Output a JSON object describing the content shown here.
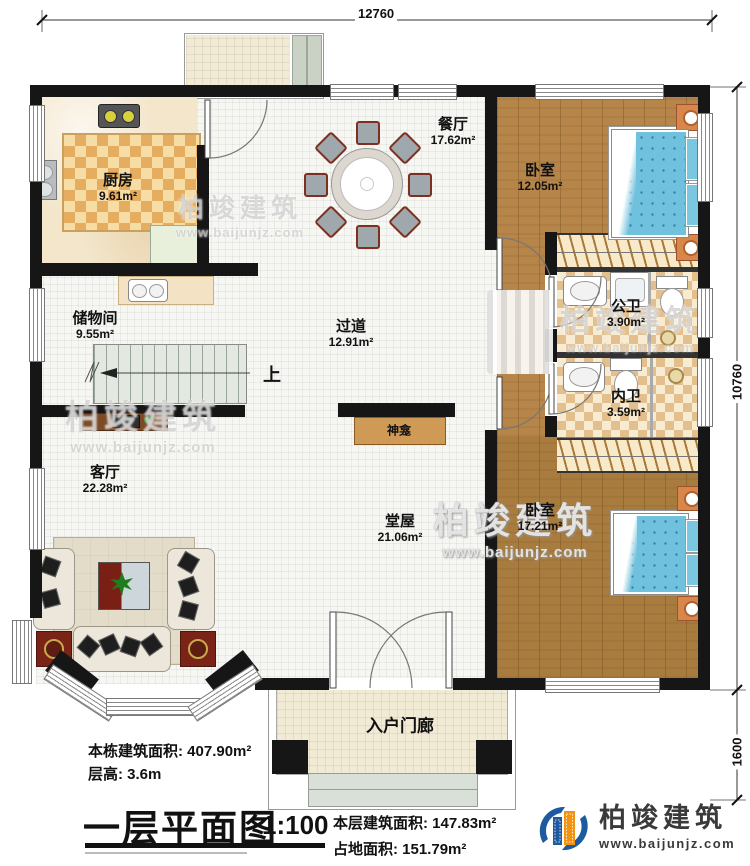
{
  "dimensions": {
    "top": "12760",
    "right": "10760",
    "right_lower": "1600"
  },
  "rooms": {
    "kitchen": {
      "name": "厨房",
      "area": "9.61m²"
    },
    "dining": {
      "name": "餐厅",
      "area": "17.62m²"
    },
    "bedroom1": {
      "name": "卧室",
      "area": "12.05m²"
    },
    "storage": {
      "name": "储物间",
      "area": "9.55m²"
    },
    "hallway": {
      "name": "过道",
      "area": "12.91m²"
    },
    "bath_public": {
      "name": "公卫",
      "area": "3.90m²"
    },
    "bath_private": {
      "name": "内卫",
      "area": "3.59m²"
    },
    "living": {
      "name": "客厅",
      "area": "22.28m²"
    },
    "main_hall": {
      "name": "堂屋",
      "area": "21.06m²"
    },
    "bedroom2": {
      "name": "卧室",
      "area": "17.21m²"
    },
    "porch": {
      "name": "入户门廊"
    }
  },
  "annotations": {
    "stairs_up": "上",
    "shrine": "神龛"
  },
  "title_block": {
    "total_area_label": "本栋建筑面积:",
    "total_area_value": "407.90m²",
    "floor_height_label": "层高:",
    "floor_height_value": "3.6m",
    "plan_title": "一层平面图",
    "scale": "1:100",
    "floor_area_label": "本层建筑面积:",
    "floor_area_value": "147.83m²",
    "footprint_label": "占地面积:",
    "footprint_value": "151.79m²"
  },
  "brand": {
    "name": "柏竣建筑",
    "website": "www.baijunjz.com"
  },
  "watermark": {
    "name": "柏竣建筑",
    "website": "www.baijunjz.com"
  }
}
